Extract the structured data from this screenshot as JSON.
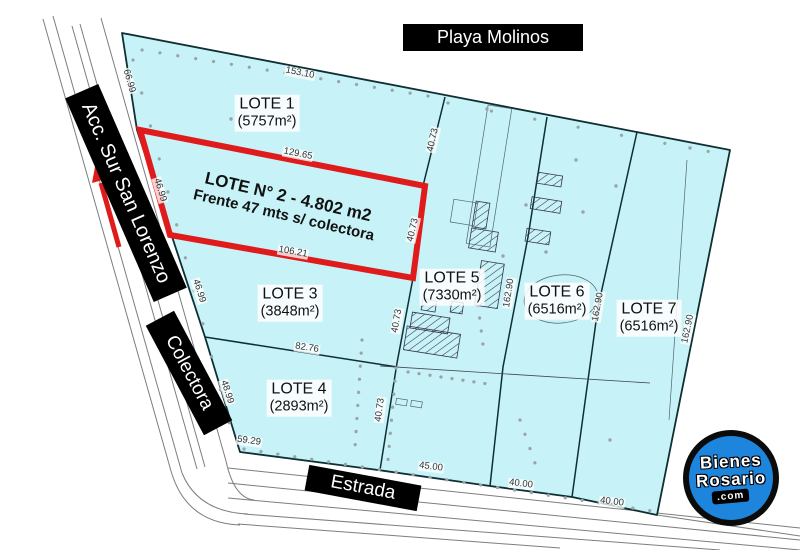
{
  "roads": {
    "top": "Playa Molinos",
    "left_upper": "Acc. Sur San Lorenzo",
    "left_lower": "Colectora",
    "bottom": "Estrada"
  },
  "highlighted_lot": {
    "line1": "LOTE N° 2 - 4.802 m2",
    "line2": "Frente 47 mts s/ colectora"
  },
  "lots": [
    {
      "name": "LOTE 1",
      "area": "(5757m²)",
      "x": 267,
      "y": 113
    },
    {
      "name": "LOTE 3",
      "area": "(3848m²)",
      "x": 290,
      "y": 303
    },
    {
      "name": "LOTE 4",
      "area": "(2893m²)",
      "x": 299,
      "y": 398
    },
    {
      "name": "LOTE 5",
      "area": "(7330m²)",
      "x": 452,
      "y": 287
    },
    {
      "name": "LOTE 6",
      "area": "(6516m²)",
      "x": 557,
      "y": 301
    },
    {
      "name": "LOTE 7",
      "area": "(6516m²)",
      "x": 649,
      "y": 318
    }
  ],
  "dimensions": [
    {
      "value": "153.10",
      "x": 300,
      "y": 73,
      "rot": 11
    },
    {
      "value": "66.99",
      "x": 129,
      "y": 81,
      "rot": 74
    },
    {
      "value": "46.99",
      "x": 160,
      "y": 190,
      "rot": 73
    },
    {
      "value": "46.99",
      "x": 199,
      "y": 291,
      "rot": 72
    },
    {
      "value": "48.99",
      "x": 227,
      "y": 392,
      "rot": 72
    },
    {
      "value": "129.65",
      "x": 298,
      "y": 154,
      "rot": 11
    },
    {
      "value": "106.21",
      "x": 293,
      "y": 252,
      "rot": 10
    },
    {
      "value": "82.76",
      "x": 307,
      "y": 348,
      "rot": 9
    },
    {
      "value": "59.29",
      "x": 249,
      "y": 441,
      "rot": 8
    },
    {
      "value": "45.00",
      "x": 431,
      "y": 467,
      "rot": 7
    },
    {
      "value": "40.00",
      "x": 521,
      "y": 484,
      "rot": 7
    },
    {
      "value": "40.00",
      "x": 612,
      "y": 502,
      "rot": 7
    },
    {
      "value": "40.73",
      "x": 433,
      "y": 140,
      "rot": -77
    },
    {
      "value": "40.73",
      "x": 413,
      "y": 230,
      "rot": -77
    },
    {
      "value": "40.73",
      "x": 397,
      "y": 321,
      "rot": -80
    },
    {
      "value": "40.73",
      "x": 380,
      "y": 410,
      "rot": -82
    },
    {
      "value": "162.90",
      "x": 509,
      "y": 293,
      "rot": -81
    },
    {
      "value": "162.90",
      "x": 598,
      "y": 307,
      "rot": -80
    },
    {
      "value": "162.90",
      "x": 688,
      "y": 329,
      "rot": -78
    }
  ],
  "logo": {
    "word1": "Bienes",
    "word2": "Rosario",
    "badge": ".com"
  },
  "colors": {
    "lot_fill": "#c7f2f7",
    "boundary": "#0e2f33",
    "highlight_red": "#e01b1b",
    "highlight_yellow": "#ffff00",
    "road_label_bg": "#000000",
    "logo_blue": "#1e85dc"
  }
}
